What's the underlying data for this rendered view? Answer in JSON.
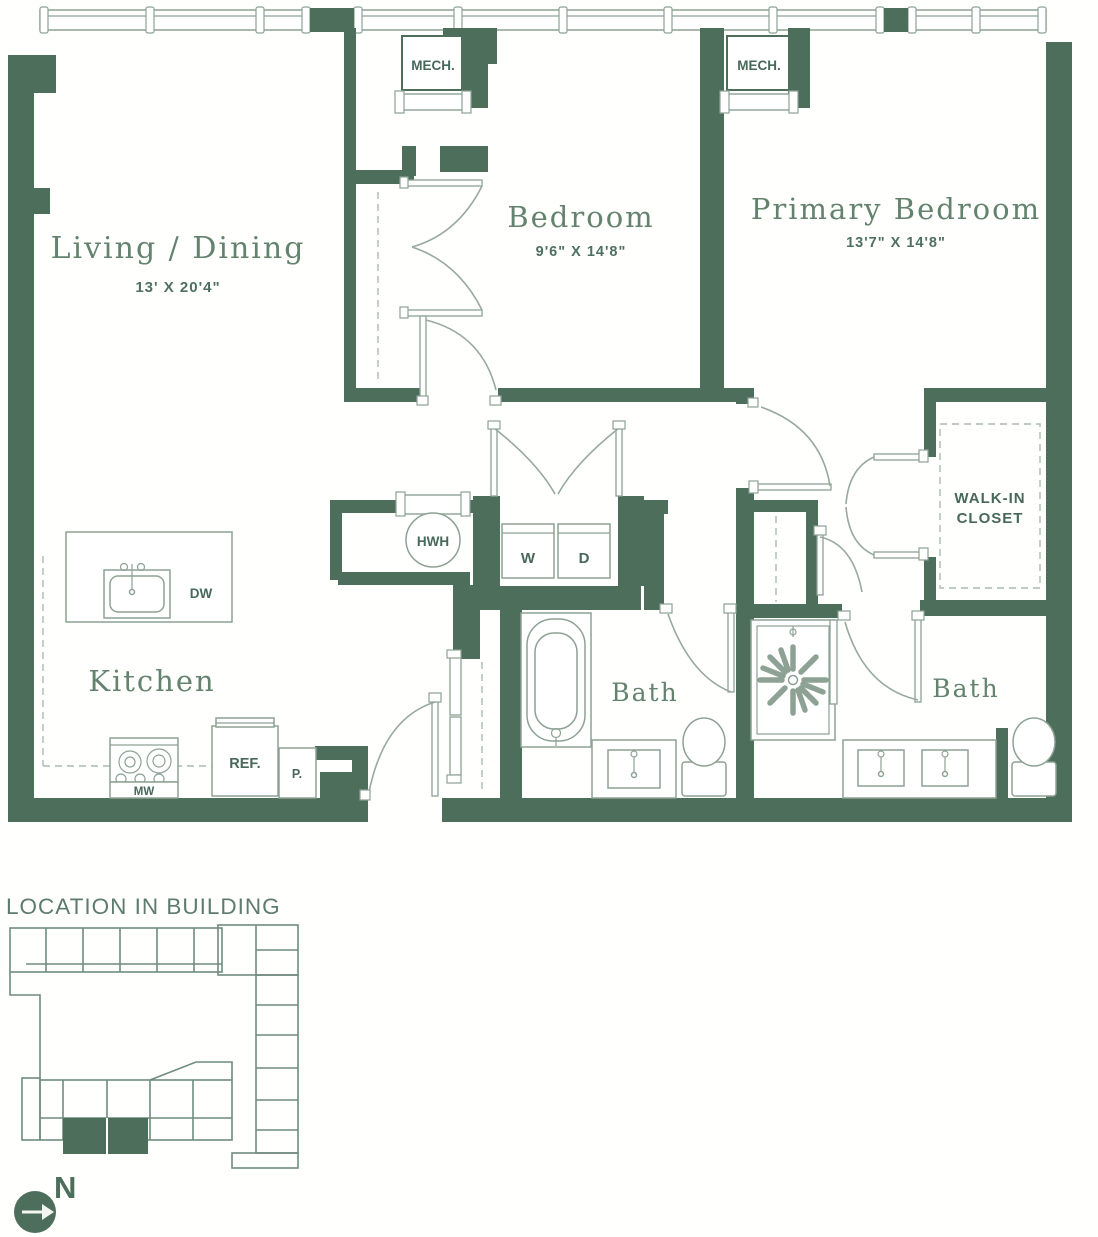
{
  "floorplan": {
    "rooms": {
      "living": {
        "label": "Living / Dining",
        "dim": "13' X 20'4\""
      },
      "bedroom": {
        "label": "Bedroom",
        "dim": "9'6\" X 14'8\""
      },
      "primary": {
        "label": "Primary Bedroom",
        "dim": "13'7\" X 14'8\""
      },
      "kitchen": {
        "label": "Kitchen"
      },
      "bath_left": {
        "label": "Bath"
      },
      "bath_right": {
        "label": "Bath"
      },
      "walk_in_closet": {
        "line1": "WALK-IN",
        "line2": "CLOSET"
      },
      "mech_left": {
        "label": "MECH."
      },
      "mech_right": {
        "label": "MECH."
      }
    },
    "fixtures": {
      "water_heater": "HWH",
      "washer": "W",
      "dryer": "D",
      "dishwasher": "DW",
      "microwave": "MW",
      "refrigerator": "REF.",
      "pantry": "P."
    },
    "colors": {
      "wall": "#4e6e5c",
      "fixture_line": "#8da294",
      "label_text": "#64836f"
    }
  },
  "location_section": {
    "title": "LOCATION IN BUILDING",
    "north_label": "N"
  }
}
